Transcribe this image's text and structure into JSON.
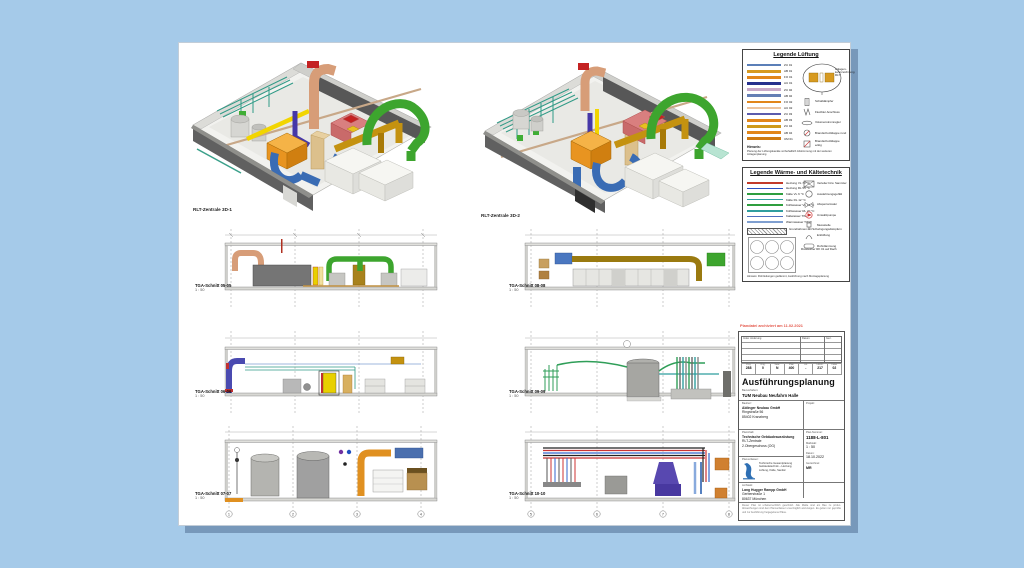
{
  "desktop": {
    "background_color": "#a5cae9"
  },
  "sheet": {
    "background_color": "#ffffff",
    "shadow_color": "rgba(64,92,128,0.45)"
  },
  "iso_views": {
    "view1": {
      "caption": "RLT-Zentrale 3D-1"
    },
    "view2": {
      "caption": "RLT-Zentrale 3D-2"
    }
  },
  "sections": [
    {
      "caption": "TGA-Schnitt 05-05",
      "scale": "1 : 50"
    },
    {
      "caption": "TGA-Schnitt 06-06",
      "scale": "1 : 50"
    },
    {
      "caption": "TGA-Schnitt 07-07",
      "scale": "1 : 50"
    },
    {
      "caption": "TGA-Schnitt 08-08",
      "scale": "1 : 50"
    },
    {
      "caption": "TGA-Schnitt 09-09",
      "scale": "1 : 50"
    },
    {
      "caption": "TGA-Schnitt 10-10",
      "scale": "1 : 50"
    }
  ],
  "axis_bubbles_left": [
    "1",
    "2",
    "3",
    "4"
  ],
  "axis_bubbles_right": [
    "5",
    "6",
    "7",
    "8"
  ],
  "legend_ventilation": {
    "title": "Legende Lüftung",
    "rows": [
      {
        "color": "#5b7fb8",
        "label": "ZU 01"
      },
      {
        "color": "#d79a20",
        "label": "AB 01"
      },
      {
        "color": "#e2861a",
        "label": "FO 01"
      },
      {
        "color": "#26318e",
        "label": "AU 01"
      },
      {
        "color": "#c9a9c9",
        "label": "ZU 02"
      },
      {
        "color": "#647fb5",
        "label": "AB 02"
      },
      {
        "color": "#e2861a",
        "label": "FO 02"
      },
      {
        "color": "#edc49e",
        "label": "AU 02"
      },
      {
        "color": "#5b5bad",
        "label": "ZU 03"
      },
      {
        "color": "#e2861a",
        "label": "AB 03"
      },
      {
        "color": "#cf9a1a",
        "label": "ZU 04"
      },
      {
        "color": "#e2861a",
        "label": "AB 04"
      },
      {
        "color": "#cf7a10",
        "label": "UM 01"
      }
    ],
    "detail_label": "Anlagen-kennzeichnung RLT",
    "symbols": [
      {
        "name": "silencer",
        "label": "Schalldämpfer"
      },
      {
        "name": "flex-connector",
        "label": "Flexibler Anschluss"
      },
      {
        "name": "volume-controller",
        "label": "Volumenstromregler"
      },
      {
        "name": "fire-damper-round",
        "label": "Brandschutzklappe rund"
      },
      {
        "name": "fire-damper-square",
        "label": "Brandschutzklappe eckig"
      }
    ],
    "note_label": "Hinweis:",
    "note": "Planung der Lüftungskanäle vorbehaltlich Abstimmung mit der weiteren Anlagenplanung"
  },
  "legend_hvac": {
    "title": "Legende Wärme- und Kältetechnik",
    "rows": [
      {
        "color": "#c23a2a",
        "label": "Heizung VL 70 °C"
      },
      {
        "color": "#2a4fc0",
        "label": "Heizung RL 55 °C"
      },
      {
        "color": "#2f9e3f",
        "label": "Kälte VL 6 °C"
      },
      {
        "color": "#2f9e9e",
        "label": "Kälte RL 12 °C"
      },
      {
        "color": "#2f9e3f",
        "label": "Kühlwasser VL 14 °C"
      },
      {
        "color": "#2f9e9e",
        "label": "Kühlwasser RL 20 °C"
      },
      {
        "color": "#4f6fbf",
        "label": "Kaltwasser TW"
      },
      {
        "color": "#7f9fd0",
        "label": "Warmwasser TWW"
      }
    ],
    "symbols": [
      {
        "name": "distributor",
        "label": "Verteiler bzw. Sammler"
      },
      {
        "name": "expansion-vessel",
        "label": "Ausdehnungsgefäß"
      },
      {
        "name": "shutoff-valve",
        "label": "Absperrarmatur"
      },
      {
        "name": "pump",
        "label": "Umwälzpumpe"
      },
      {
        "name": "sensor",
        "label": "Messstelle"
      },
      {
        "name": "vent",
        "label": "Entlüftung"
      },
      {
        "name": "insulation",
        "label": "Rohrdämmung"
      }
    ],
    "foundation_label": "Grundrahmen mit Schwingungsdämpfern",
    "chiller_label": "Rückkühler RK 01 auf Dach",
    "note": "Hinweis: Rohrleitungen gedämmt, Ausführung nach Montageplanung"
  },
  "archive_note": "Plandatei archiviert am 11.02.2021",
  "title_block": {
    "rev_header_left": "Index  Änderung",
    "rev_header_mid": "Datum",
    "rev_header_right": "Gez.",
    "code_labels": [
      "Proj.",
      "Orig.",
      "Gew.",
      "Plan",
      "Art",
      "Lfd-Nr.",
      "Index"
    ],
    "code_values": [
      "288",
      "0",
      "N",
      "400",
      "-",
      "217",
      "02"
    ],
    "phase_title": "Ausführungsplanung",
    "project_label": "Bauvorhaben:",
    "project_name": "TUM Neubau Neufahrn Halle",
    "client_label": "Bauherr:",
    "client_lines": [
      "Aldinger Neubau GmbH",
      "Ringstraße 56",
      "85402 Kranzberg"
    ],
    "side_project_label": "Projekt:",
    "content_label": "Planinhalt:",
    "content_lines": [
      "Technische Gebäudeausrüstung",
      "RLT-Zentrale",
      "2.Obergeschoss (OG)"
    ],
    "plan_no_label": "Plan-Nummer:",
    "plan_no": "1188-L-801",
    "scale_label": "Maßstab:",
    "scale": "1 : 50",
    "date_label": "Datum:",
    "date": "18.10.2022",
    "drawn_label": "Gezeichnet:",
    "drawn": "MR",
    "author_label": "Planverfasser:",
    "author_note": "Technische Gesamtplanung Gebäudetechnik – Heizung, Lüftung, Kälte, Sanitär",
    "architect_label": "Architekt:",
    "architect_lines": [
      "Lang Hugger Rampp GmbH",
      "Gerberstraße 1",
      "80637 München"
    ],
    "disclaimer": "Dieser Plan ist urheberrechtlich geschützt. Alle Maße sind am Bau zu prüfen. Abweichungen sind dem Planverfasser unverzüglich anzuzeigen. Es gelten nur geprüfte und zur Ausführung freigegebene Pläne."
  },
  "palette": {
    "duct_blue": "#3a6cb4",
    "duct_green": "#3da52e",
    "duct_gold": "#c49210",
    "duct_copper": "#d79d78",
    "duct_orange": "#f0a43a",
    "duct_yellow": "#f2d500",
    "duct_purple": "#4638a8",
    "pipe_teal": "#2f9a86",
    "equipment_red": "#c42222",
    "wall_dark": "#5e5e5e"
  }
}
